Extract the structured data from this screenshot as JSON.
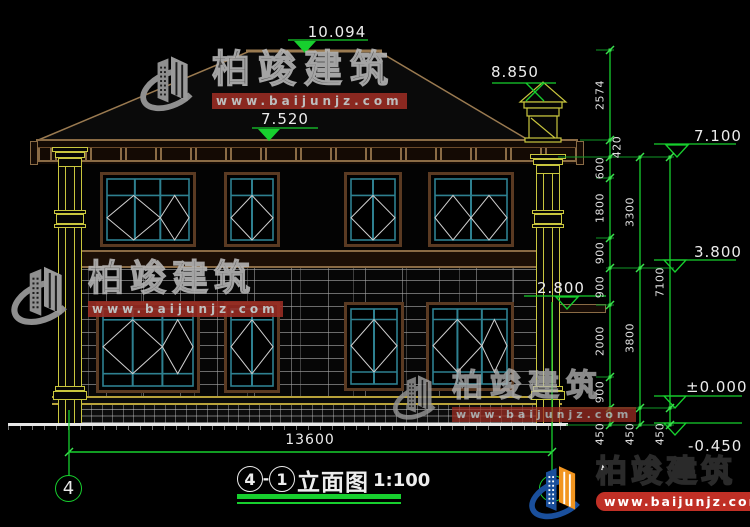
{
  "drawing": {
    "title": {
      "bubble_a": "4",
      "separator": "-",
      "bubble_b": "1",
      "name": "立面图",
      "scale": "1:100"
    },
    "grid_bubbles": {
      "left": "4",
      "right": "1"
    },
    "levels": {
      "ridge": "10.094",
      "chimney": "8.850",
      "eaves": "7.520",
      "floor2": "7.100",
      "belt": "3.800",
      "canopy": "2.800",
      "zero": "±0.000",
      "ground": "-0.450"
    },
    "dims": {
      "right_inner": [
        "2574",
        "420",
        "600",
        "1800",
        "900",
        "900",
        "2000",
        "900",
        "450"
      ],
      "right_mid": [
        "3300",
        "3800",
        "450"
      ],
      "right_outer": [
        "7100",
        "450"
      ],
      "bottom_width": "13600"
    }
  },
  "watermark": {
    "brand": "柏竣建筑",
    "url": "www.baijunjz.com"
  },
  "colors": {
    "dim_green": "#17cf2e",
    "cad_tan": "#8a6b45",
    "window_teal": "#2e8090",
    "column_yellow": "#c9c63e",
    "logo_blue": "#1a4f9c",
    "logo_orange": "#f2951f",
    "url_red": "#c03026"
  }
}
